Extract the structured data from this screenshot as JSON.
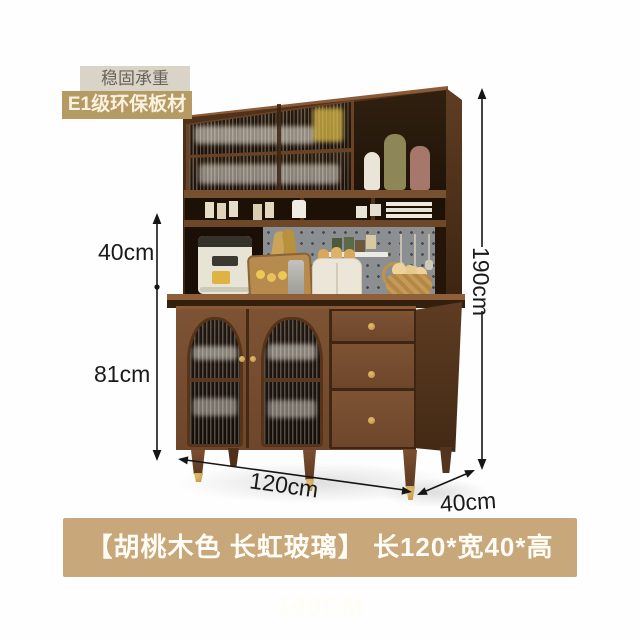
{
  "badges": [
    {
      "label": "稳固承重"
    },
    {
      "label": "E1级环保板材"
    }
  ],
  "dimensions": {
    "upper_section_height": "40cm",
    "lower_section_height": "81cm",
    "total_height": "190cm",
    "width": "120cm",
    "depth": "40cm"
  },
  "banner": {
    "label": "【胡桃木色 长虹玻璃】  长120*宽40*高190CM"
  },
  "product": {
    "type": "kitchen-sideboard-cabinet",
    "finish": "walnut",
    "glass": "changhong-fluted-glass"
  },
  "colors": {
    "banner_bg": "#c8a77a",
    "badge_tan_bg": "#b69a64",
    "badge_gray_bg": "#d9d3c8",
    "walnut_wood": "#7d5334",
    "gold_hardware": "#c79f4e",
    "pegboard_gray": "#8b8f91",
    "dimension_line": "#151515"
  },
  "icons": {
    "arrows": "double-headed dimension arrows"
  }
}
